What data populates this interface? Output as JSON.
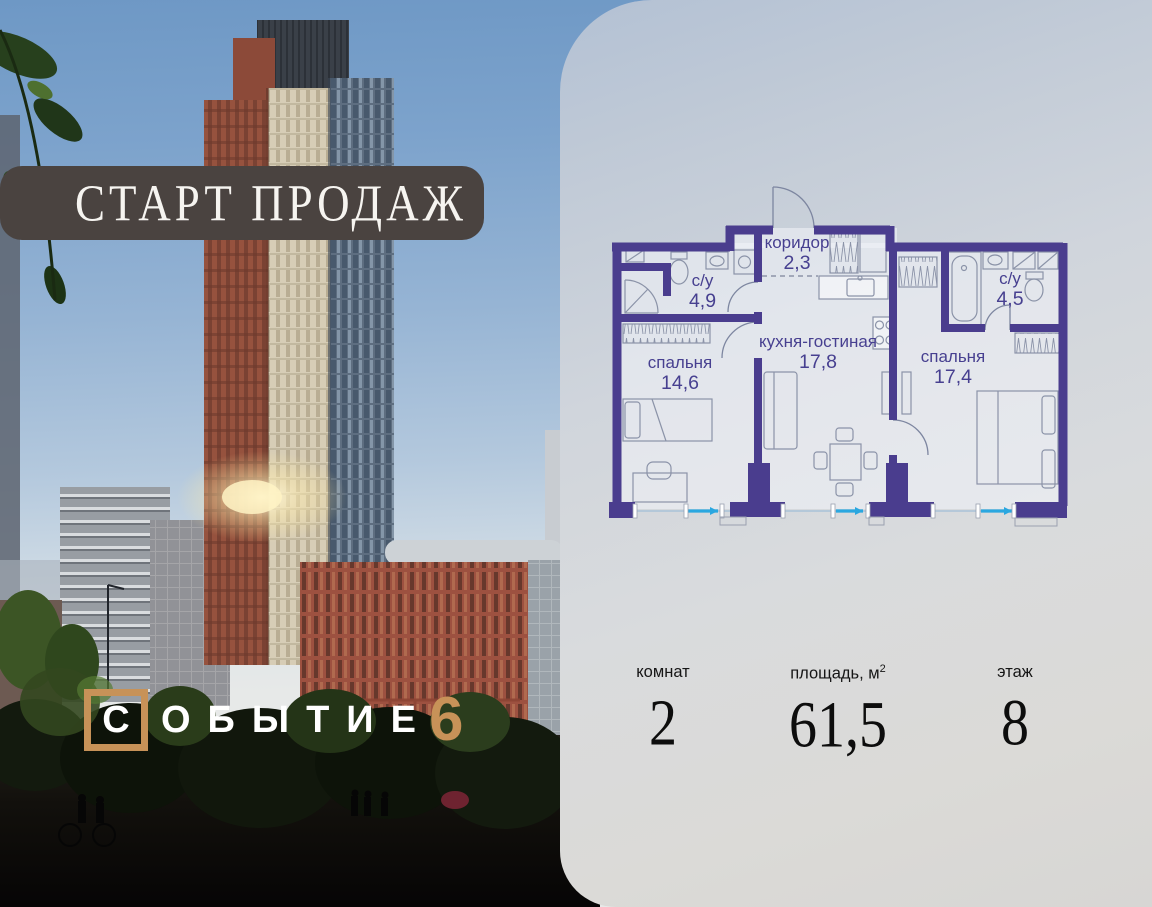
{
  "banner": {
    "label": "СТАРТ ПРОДАЖ"
  },
  "logo": {
    "first_letter": "С",
    "rest": "ОБЫТИЕ",
    "number": "6",
    "accent_color": "#c79258"
  },
  "floor_plan": {
    "rooms": [
      {
        "name": "с/у",
        "area": "4,9"
      },
      {
        "name": "коридор",
        "area": "2,3"
      },
      {
        "name": "кухня-гостиная",
        "area": "17,8"
      },
      {
        "name": "спальня",
        "area": "14,6"
      },
      {
        "name": "с/у",
        "area": "4,5"
      },
      {
        "name": "спальня",
        "area": "17,4"
      }
    ],
    "colors": {
      "wall": "#4a3d8e",
      "window": "#2aa7e0"
    }
  },
  "stats": [
    {
      "label": "комнат",
      "value": "2"
    },
    {
      "label": "площадь, м",
      "sup": "2",
      "value": "61,5"
    },
    {
      "label": "этаж",
      "value": "8"
    }
  ]
}
